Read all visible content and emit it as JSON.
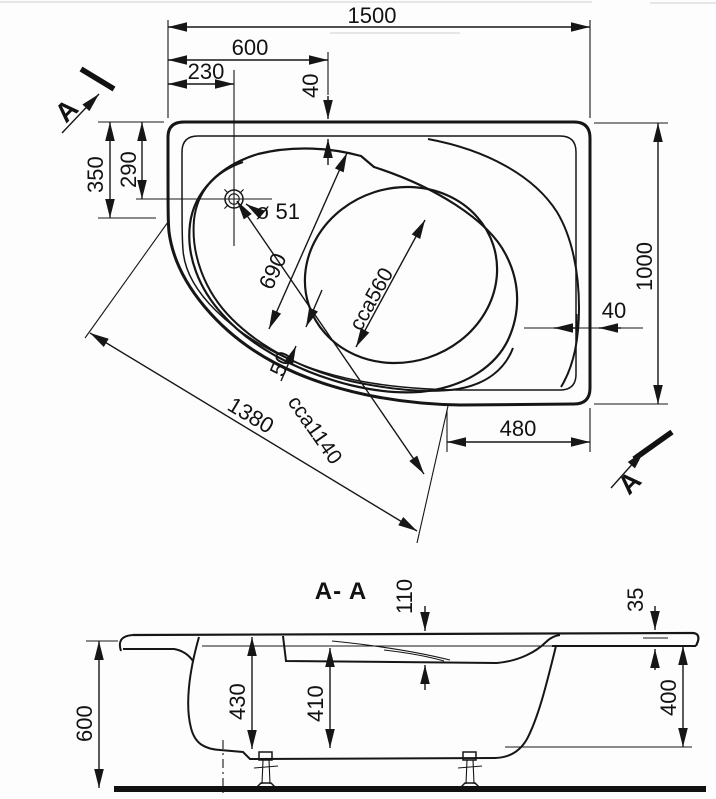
{
  "drawing": {
    "type": "bathtub technical drawing, plan view and section",
    "plan": {
      "dim_width_total": "1500",
      "dim_width_600": "600",
      "dim_width_230": "230",
      "dim_rim_top_40": "40",
      "dim_left_350": "350",
      "dim_left_290": "290",
      "drain_diameter": "ø 51",
      "dim_diag_690": "690",
      "dim_seat_width": "cca560",
      "dim_lip_50": "50",
      "dim_inner_length": "cca1140",
      "dim_front_length": "1380",
      "dim_height_total": "1000",
      "dim_rim_right_40": "40",
      "dim_bottom_480": "480",
      "section_marker": "A"
    },
    "section": {
      "title": "A- A",
      "dim_rim_110": "110",
      "dim_rim_35": "35",
      "dim_height_600": "600",
      "dim_depth_430": "430",
      "dim_depth_410": "410",
      "dim_side_400": "400"
    }
  }
}
